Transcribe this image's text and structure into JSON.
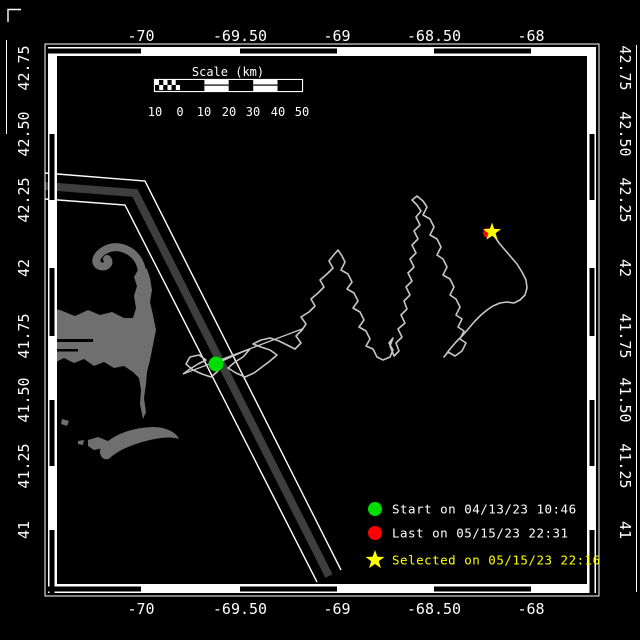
{
  "window": {
    "width": 640,
    "height": 640,
    "bg": "#000000"
  },
  "axes": {
    "color": "#ffffff",
    "lon_ticks": [
      {
        "label": "-70",
        "x": 141
      },
      {
        "label": "-69.50",
        "x": 240
      },
      {
        "label": "-69",
        "x": 337
      },
      {
        "label": "-68.50",
        "x": 434
      },
      {
        "label": "-68",
        "x": 531
      }
    ],
    "lat_ticks": [
      {
        "label": "42.75",
        "y": 68
      },
      {
        "label": "42.50",
        "y": 134
      },
      {
        "label": "42.25",
        "y": 200
      },
      {
        "label": "42",
        "y": 268
      },
      {
        "label": "41.75",
        "y": 336
      },
      {
        "label": "41.50",
        "y": 400
      },
      {
        "label": "41.25",
        "y": 466
      },
      {
        "label": "41",
        "y": 530
      }
    ]
  },
  "frame": {
    "x": 48,
    "y": 47,
    "x2": 596,
    "y2": 593,
    "bar": 9,
    "color": "#ffffff",
    "seg_color": "#000000",
    "h_black_segs": [
      [
        48,
        141
      ],
      [
        240,
        337
      ],
      [
        434,
        531
      ]
    ],
    "v_black_segs": [
      [
        134,
        200
      ],
      [
        268,
        336
      ],
      [
        400,
        466
      ],
      [
        530,
        593
      ]
    ]
  },
  "scalebar": {
    "title": "Scale (km)",
    "title_x": 228,
    "title_y": 76,
    "x": 155,
    "y": 80,
    "width": 147,
    "height": 11,
    "checker_end": 180,
    "tick_labels": [
      "10",
      "0",
      "10",
      "20",
      "30",
      "40",
      "50"
    ],
    "tick_label_x": [
      155,
      180,
      204,
      229,
      253,
      278,
      302
    ],
    "label_y": 116
  },
  "legend": {
    "marker_x": 375,
    "text_x": 392,
    "items": [
      {
        "name": "start",
        "marker": "circle",
        "marker_color": "#00dd00",
        "label": "Start on 04/13/23 10:46",
        "label_color": "#ffffff",
        "y": 509
      },
      {
        "name": "last",
        "marker": "circle",
        "marker_color": "#ff0000",
        "label": "Last on 05/15/23 22:31",
        "label_color": "#ffffff",
        "y": 533
      },
      {
        "name": "selected",
        "marker": "star",
        "marker_color": "#ffff00",
        "label": "Selected on 05/15/23 22:16",
        "label_color": "#ffff00",
        "y": 560
      }
    ]
  },
  "map": {
    "land_color": "#6f6f6f",
    "lane_color": "#3e3e3e",
    "track_color": "#c6c6c6",
    "markers": {
      "start": {
        "x": 216,
        "y": 364,
        "r": 7.5,
        "color": "#00dd00"
      },
      "last": {
        "x": 488,
        "y": 233,
        "r": 5,
        "color": "#ff0000"
      },
      "selected": {
        "x": 492,
        "y": 232,
        "R": 9.5,
        "r": 3.8,
        "color": "#ffff00"
      }
    },
    "lane": {
      "center": "45,186 135,193 329,576",
      "upper": "45,173 145,181 341,570",
      "lower": "45,199 125,205 317,582",
      "center_width": 8,
      "line_width": 1.4
    },
    "transit_line": "183,374 302,329",
    "track_points": [
      [
        183,
        374
      ],
      [
        190,
        369
      ],
      [
        198,
        364
      ],
      [
        206,
        360
      ],
      [
        199,
        355
      ],
      [
        190,
        357
      ],
      [
        186,
        364
      ],
      [
        193,
        370
      ],
      [
        202,
        374
      ],
      [
        211,
        377
      ],
      [
        218,
        371
      ],
      [
        216,
        364
      ],
      [
        224,
        360
      ],
      [
        233,
        356
      ],
      [
        242,
        352
      ],
      [
        250,
        349
      ],
      [
        243,
        357
      ],
      [
        235,
        362
      ],
      [
        228,
        368
      ],
      [
        236,
        373
      ],
      [
        245,
        377
      ],
      [
        254,
        373
      ],
      [
        262,
        367
      ],
      [
        270,
        361
      ],
      [
        277,
        355
      ],
      [
        270,
        350
      ],
      [
        261,
        347
      ],
      [
        253,
        344
      ],
      [
        261,
        340
      ],
      [
        270,
        338
      ],
      [
        279,
        341
      ],
      [
        287,
        345
      ],
      [
        295,
        349
      ],
      [
        301,
        343
      ],
      [
        296,
        336
      ],
      [
        302,
        330
      ],
      [
        306,
        324
      ],
      [
        301,
        317
      ],
      [
        309,
        312
      ],
      [
        315,
        306
      ],
      [
        311,
        299
      ],
      [
        318,
        293
      ],
      [
        324,
        287
      ],
      [
        320,
        280
      ],
      [
        327,
        274
      ],
      [
        333,
        268
      ],
      [
        329,
        261
      ],
      [
        332,
        257
      ],
      [
        338,
        250
      ],
      [
        342,
        256
      ],
      [
        345,
        262
      ],
      [
        341,
        270
      ],
      [
        348,
        274
      ],
      [
        352,
        282
      ],
      [
        347,
        289
      ],
      [
        354,
        293
      ],
      [
        358,
        301
      ],
      [
        353,
        308
      ],
      [
        360,
        312
      ],
      [
        364,
        320
      ],
      [
        359,
        327
      ],
      [
        366,
        331
      ],
      [
        370,
        339
      ],
      [
        366,
        346
      ],
      [
        373,
        349
      ],
      [
        377,
        357
      ],
      [
        383,
        360
      ],
      [
        390,
        357
      ],
      [
        393,
        350
      ],
      [
        389,
        343
      ],
      [
        393,
        338
      ],
      [
        390,
        346
      ],
      [
        394,
        356
      ],
      [
        399,
        351
      ],
      [
        396,
        343
      ],
      [
        402,
        337
      ],
      [
        398,
        329
      ],
      [
        405,
        323
      ],
      [
        401,
        315
      ],
      [
        407,
        309
      ],
      [
        404,
        301
      ],
      [
        410,
        295
      ],
      [
        406,
        287
      ],
      [
        412,
        281
      ],
      [
        408,
        273
      ],
      [
        414,
        267
      ],
      [
        410,
        259
      ],
      [
        416,
        253
      ],
      [
        412,
        245
      ],
      [
        418,
        239
      ],
      [
        414,
        231
      ],
      [
        420,
        225
      ],
      [
        416,
        217
      ],
      [
        421,
        211
      ],
      [
        417,
        205
      ],
      [
        412,
        200
      ],
      [
        417,
        196
      ],
      [
        423,
        201
      ],
      [
        427,
        207
      ],
      [
        423,
        215
      ],
      [
        430,
        219
      ],
      [
        434,
        227
      ],
      [
        430,
        235
      ],
      [
        437,
        239
      ],
      [
        441,
        247
      ],
      [
        437,
        255
      ],
      [
        443,
        259
      ],
      [
        447,
        267
      ],
      [
        443,
        275
      ],
      [
        450,
        279
      ],
      [
        454,
        287
      ],
      [
        450,
        295
      ],
      [
        456,
        299
      ],
      [
        460,
        307
      ],
      [
        456,
        315
      ],
      [
        462,
        319
      ],
      [
        458,
        327
      ],
      [
        464,
        331
      ],
      [
        460,
        339
      ],
      [
        466,
        343
      ],
      [
        462,
        351
      ],
      [
        455,
        356
      ],
      [
        448,
        352
      ],
      [
        444,
        357
      ],
      [
        450,
        349
      ],
      [
        456,
        342
      ],
      [
        463,
        335
      ],
      [
        469,
        328
      ],
      [
        475,
        321
      ],
      [
        481,
        315
      ],
      [
        487,
        310
      ],
      [
        493,
        306
      ],
      [
        500,
        303
      ],
      [
        507,
        302
      ],
      [
        514,
        303
      ],
      [
        520,
        300
      ],
      [
        525,
        295
      ],
      [
        527,
        288
      ],
      [
        526,
        280
      ],
      [
        522,
        272
      ],
      [
        517,
        264
      ],
      [
        511,
        257
      ],
      [
        505,
        250
      ],
      [
        499,
        243
      ],
      [
        495,
        237
      ],
      [
        492,
        232
      ]
    ],
    "land_paths": [
      {
        "mode": "fill",
        "d": "M48,308 L60,310 L75,316 L88,310 L100,315 L112,312 L124,318 L133,318 L136,308 L134,296 L137,286 L134,277 L138,270 L142,266 L147,269 L150,278 L152,290 L150,302 L153,315 L156,330 L153,345 L150,360 L147,372 L146,384 L144,398 L146,412 L143,419 L140,404 L141,390 L139,378 L133,372 L124,366 L114,368 L104,362 L94,366 L84,359 L74,363 L64,358 L54,363 L48,360 Z"
      },
      {
        "mode": "stroke",
        "w": 8,
        "d": "M142,272 C140,252 120,243 107,249 C96,254 93,263 100,266 C106,268 111,263 107,259"
      },
      {
        "mode": "fill",
        "d": "M100,450 C108,437 128,428 152,427 C166,427 176,432 179,439 C170,436 158,438 146,441 C130,445 116,452 110,458 C104,462 99,456 100,450 Z"
      },
      {
        "mode": "fill",
        "d": "M88,440 L98,437 L108,441 L104,448 L94,450 L88,446 Z"
      },
      {
        "mode": "fill",
        "d": "M78,441 L84,440 L83,445 L78,444 Z"
      },
      {
        "mode": "fill",
        "d": "M62,419 L69,421 L67,426 L61,424 Z"
      }
    ],
    "black_slits": [
      [
        48,
        339,
        45,
        3
      ],
      [
        48,
        349,
        30,
        2.5
      ]
    ],
    "edge_marks": {
      "right_line": {
        "x": 636.5,
        "y1": 45,
        "y2": 592
      },
      "left_line": {
        "x": 6.5,
        "y1": 40,
        "y2": 134
      },
      "corner_bracket": "M8,22 L8,9.5 L21,9.5"
    }
  }
}
